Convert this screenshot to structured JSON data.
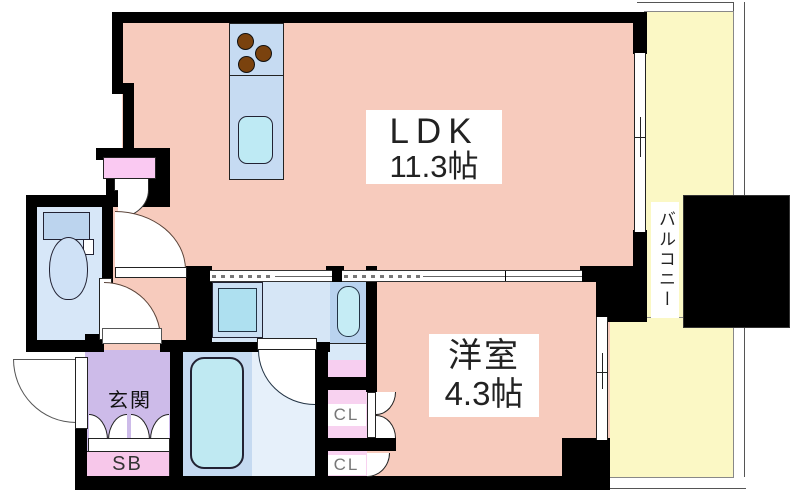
{
  "plan": {
    "ldk": {
      "name": "LDK",
      "size": "11.3帖"
    },
    "western_room": {
      "name": "洋室",
      "size": "4.3帖"
    },
    "balcony": {
      "name": "バルコニー"
    },
    "entrance": {
      "name": "玄関"
    },
    "shoe_box_label": "SB",
    "closet_upper_label": "CL",
    "closet_lower_label": "CL",
    "colors": {
      "wall": "#000000",
      "room_pink": "#F7CBBD",
      "balcony_yellow": "#FBF8C5",
      "entrance_purple": "#CDBBE9",
      "closet_pink": "#F8D2F0",
      "shoe_box_pink": "#F7C7EA",
      "counter_blue": "#C6DBF2",
      "water_cyan": "#BFE9F2",
      "toilet_room_blue": "#D7E7F8",
      "burner_brown": "#7A420E"
    }
  }
}
